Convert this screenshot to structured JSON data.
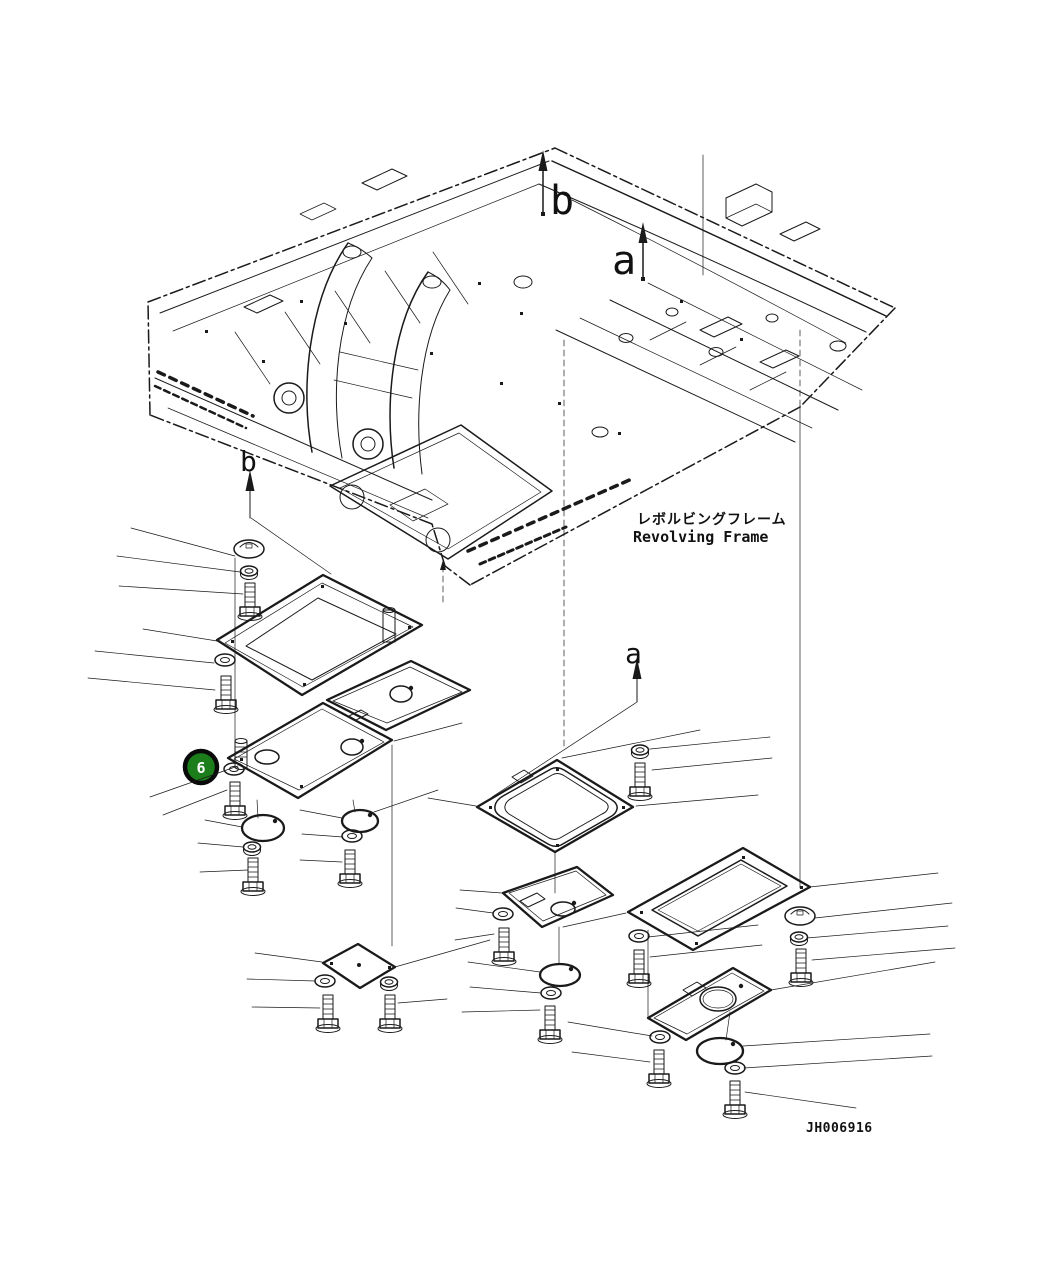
{
  "figure": {
    "type": "parts-diagram",
    "frame_title": {
      "jp": "レボルビングフレーム",
      "en": "Revolving Frame"
    },
    "drawing_code": "JH006916",
    "callout": {
      "number": "6",
      "fill": "#1b7e1b"
    },
    "view_arrows": [
      {
        "label": "b",
        "placement": "top-center"
      },
      {
        "label": "a",
        "placement": "top-right"
      },
      {
        "label": "b",
        "placement": "mid-left"
      },
      {
        "label": "a",
        "placement": "mid-center"
      }
    ]
  }
}
